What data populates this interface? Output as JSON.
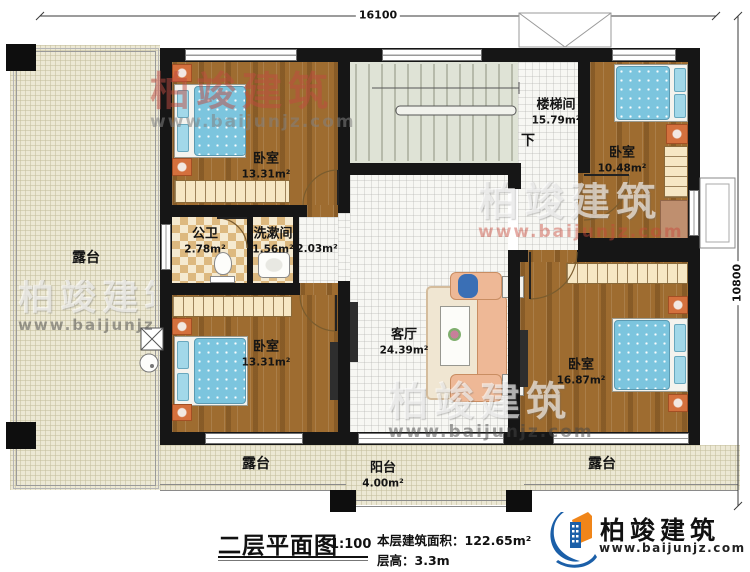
{
  "plan": {
    "dimensions": {
      "width_mm": "16100",
      "height_mm": "10800"
    },
    "rooms": {
      "bedroom_tl": {
        "label": "卧室",
        "area": "13.31m²"
      },
      "bedroom_tr": {
        "label": "卧室",
        "area": "10.48m²"
      },
      "bedroom_bl": {
        "label": "卧室",
        "area": "13.31m²"
      },
      "bedroom_br": {
        "label": "卧室",
        "area": "16.87m²"
      },
      "stairwell": {
        "label": "楼梯间",
        "area": "15.79m²",
        "direction": "下"
      },
      "public_bath": {
        "label": "公卫",
        "area": "2.78m²"
      },
      "washroom": {
        "label": "洗漱间",
        "area": "1.56m²"
      },
      "hallway": {
        "area": "2.03m²"
      },
      "living_room": {
        "label": "客厅",
        "area": "24.39m²"
      },
      "balcony": {
        "label": "阳台",
        "area": "4.00m²"
      },
      "terrace_left": {
        "label": "露台"
      },
      "terrace_bottom": {
        "label": "露台"
      },
      "terrace_right": {
        "label": "露台"
      }
    }
  },
  "titleblock": {
    "title": "二层平面图",
    "scale": "1:100",
    "floor_area_label": "本层建筑面积：",
    "floor_area_value": "122.65m²",
    "floor_height_label": "层高：",
    "floor_height_value": "3.3m"
  },
  "brand": {
    "name": "柏竣建筑",
    "website": "www.baijunjz.com"
  },
  "colors": {
    "wall": "#161616",
    "wood_floor": "#9e6c30",
    "terrace_floor": "#ece8d4",
    "stair_floor": "#dfe3d6",
    "bed_blue": "#7cc5de",
    "nightstand_orange": "#d4703d",
    "brand_blue": "#1b5fa8",
    "brand_orange": "#f08519",
    "watermark_red": "#c04a40"
  }
}
